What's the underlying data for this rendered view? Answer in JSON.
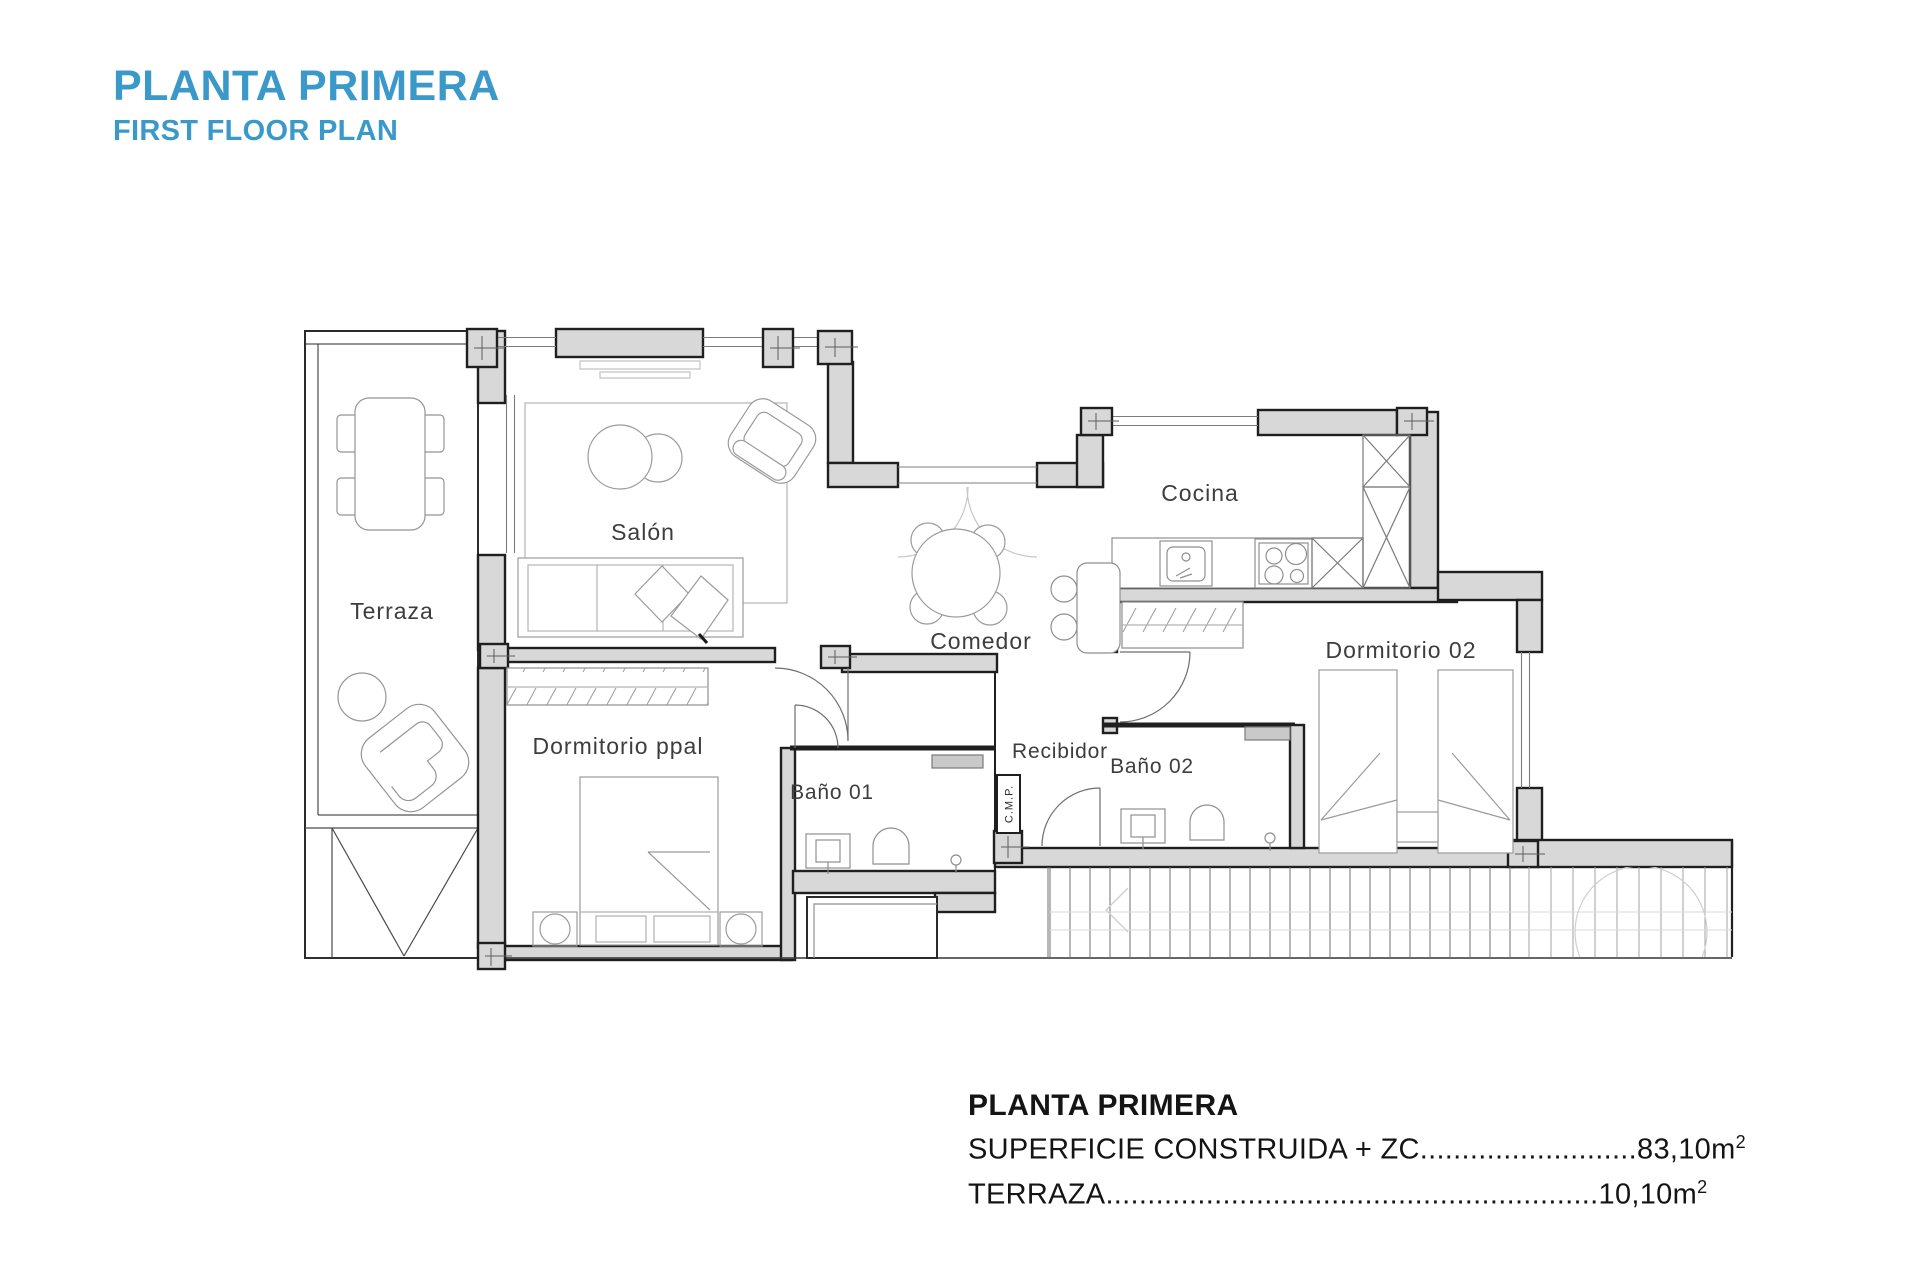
{
  "header": {
    "title": "PLANTA PRIMERA",
    "subtitle": "FIRST FLOOR PLAN"
  },
  "colors": {
    "accent": "#3b99c9",
    "wall_fill": "#d8d8d8",
    "wall_line": "#1f1f1f"
  },
  "rooms": {
    "terraza": "Terraza",
    "salon": "Salón",
    "comedor": "Comedor",
    "cocina": "Cocina",
    "dormitorio_ppal": "Dormitorio ppal",
    "dormitorio_02": "Dormitorio 02",
    "bano_01": "Baño 01",
    "bano_02": "Baño 02",
    "recibidor": "Recibidor",
    "cmp": "C.M.P."
  },
  "summary": {
    "title": "PLANTA PRIMERA",
    "rows": [
      {
        "label": "SUPERFICIE CONSTRUIDA + ZC",
        "leader": "..........................",
        "value": "83,10m",
        "sup": "2"
      },
      {
        "label": "TERRAZA",
        "leader": "...........................................................",
        "value": "10,10m",
        "sup": "2"
      }
    ]
  }
}
